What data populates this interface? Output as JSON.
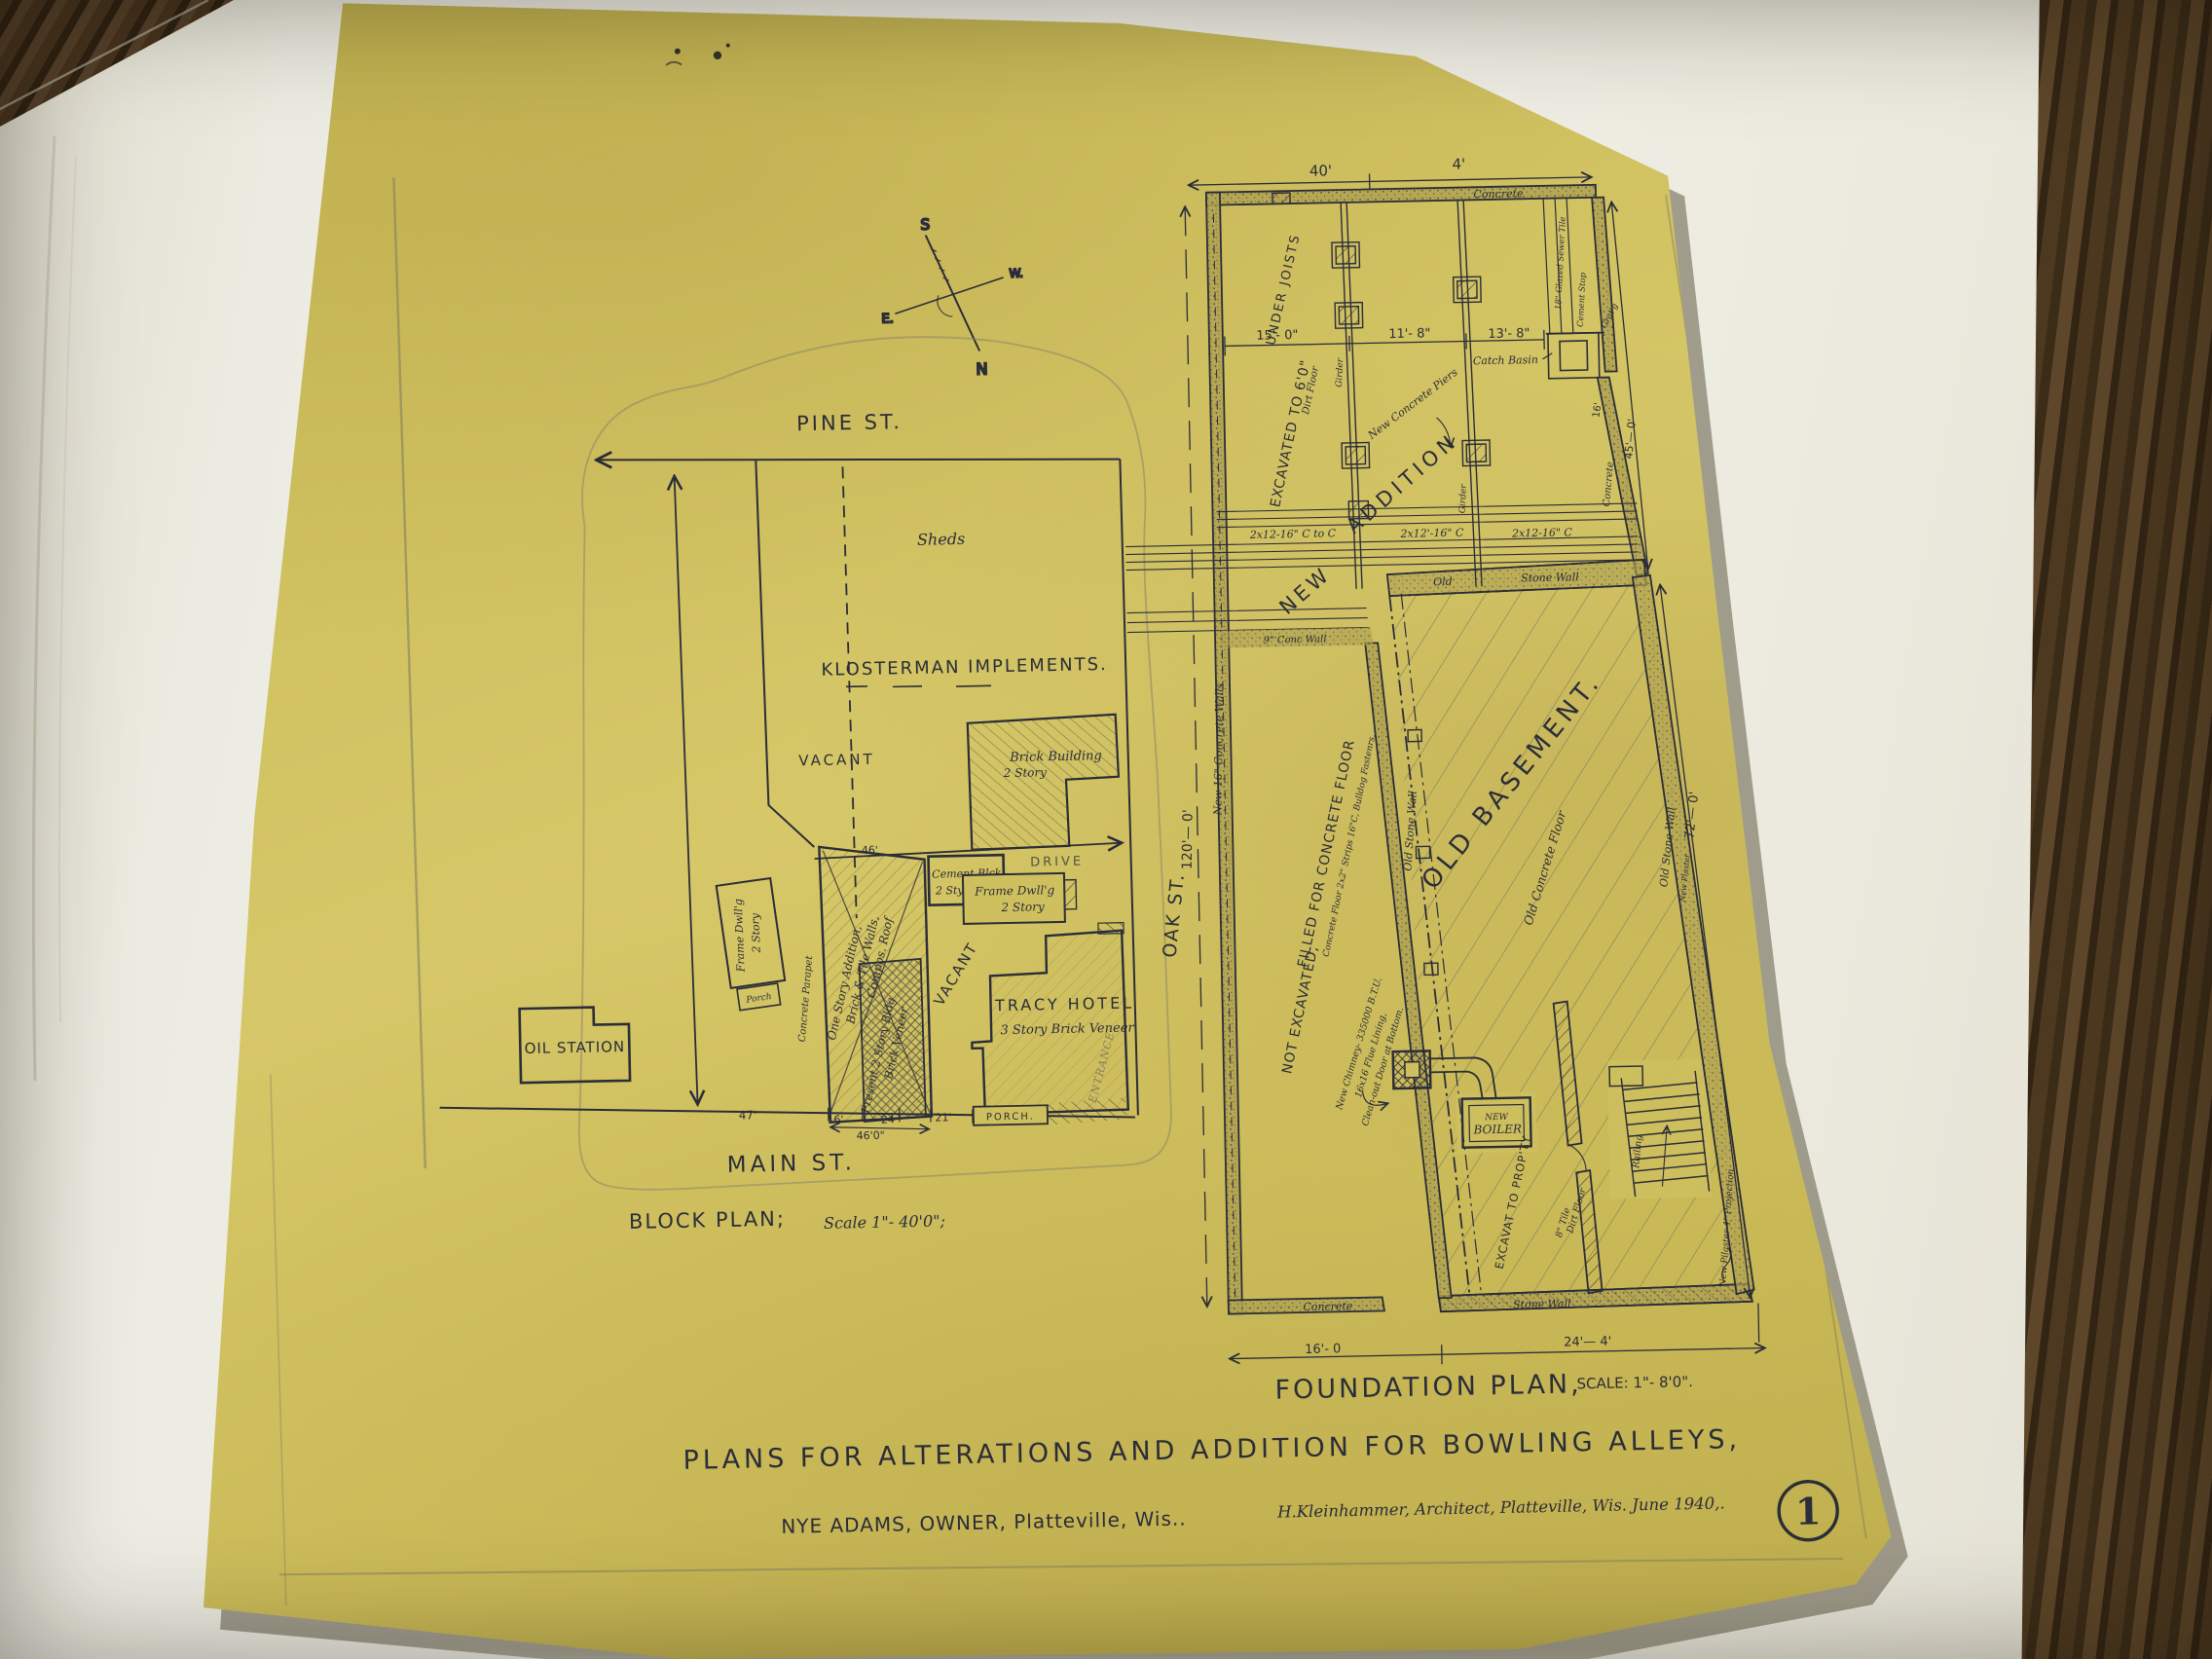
{
  "document": {
    "type": "architectural drawing photograph",
    "sheet_number": "1",
    "title": "PLANS FOR ALTERATIONS AND ADDITION FOR BOWLING ALLEYS,",
    "owner_line": "NYE ADAMS, OWNER, Platteville, Wis..",
    "architect_line": "H.Kleinhammer, Architect, Platteville, Wis. June 1940,.",
    "colors": {
      "paper": "#cfc05f",
      "ink": "#2b2d38",
      "pencil": "#84805e",
      "mat": "#ecebe1",
      "wood": "#4d3920"
    }
  },
  "compass": {
    "n": "N",
    "s": "S",
    "e": "E.",
    "w": "W."
  },
  "block_plan": {
    "caption": "BLOCK PLAN;",
    "scale": "Scale 1\"- 40'0\";",
    "streets": {
      "pine": "PINE ST.",
      "main": "MAIN ST.",
      "oak": "OAK ST."
    },
    "labels": {
      "sheds": "Sheds",
      "klosterman": "KLOSTERMAN IMPLEMENTS.",
      "vacant_parcel": "VACANT",
      "vacant_lot": "VACANT",
      "brick1": "Brick Building",
      "brick2": "2 Story",
      "drive": "DRIVE",
      "cement1": "Cement Blck",
      "cement2": "2 Sty",
      "frame_e1": "Frame Dwll'g",
      "frame_e2": "2 Story",
      "frame_w1": "Frame Dwll'g",
      "frame_w2": "2 Story",
      "porch_w": "Porch",
      "oil_station": "OIL STATION",
      "parapet": "Concrete Parapet",
      "osa1": "One Story Addition,",
      "osa2": "Brick & Tile Walls,",
      "osa3": "Compos. Roof",
      "pres1": "Present 2 Story Bldg",
      "pres2": "Brick Veneer",
      "tracy1": "TRACY HOTEL",
      "tracy2": "3 Story Brick Veneer",
      "entrance": "ENTRANCE",
      "porch_s": "PORCH."
    },
    "dims": {
      "d47": "47'",
      "d16": "16'",
      "d24": "24",
      "d21": "21'",
      "d460": "46'0\"",
      "d46": "46'"
    }
  },
  "foundation_plan": {
    "caption": "FOUNDATION PLAN,",
    "scale": "SCALE: 1\"- 8'0\".",
    "labels": {
      "concrete_top": "Concrete",
      "under_joists": "UNDER JOISTS",
      "excavated": "EXCAVATED TO 6'0\"",
      "dirt_floor": "Dirt Floor",
      "girder": "Girder",
      "piers": "New Concrete Piers",
      "addition": "ADDITION",
      "new": "NEW",
      "j1": "2x12-16\" C to C",
      "j2": "2x12'-16\" C",
      "j3": "2x12-16\" C",
      "old": "Old",
      "stone_wall": "Stone Wall",
      "conc9": "9\" Conc Wall",
      "new16": "New 16\" Concrete Walls",
      "catch_basin": "Catch Basin",
      "sewer": "18\" Glazed Sewer Tile",
      "cement_stop": "Cement Stop",
      "grating": "Grat'g",
      "concrete_r": "Concrete",
      "old_basement": "OLD BASEMENT.",
      "old_floor": "Old Concrete Floor",
      "osw_l": "Old Stone Wall",
      "osw_r": "Old Stone Wall",
      "new_plaster": "New Plaster",
      "not_exc": "NOT EXCAVATED,",
      "filled": "FILLED FOR CONCRETE FLOOR",
      "floor_note": "Concrete Floor 2x2\" Strips 16\"C, Bulldog Fastenrs.",
      "chim1": "New Chimney- 335000 B.T.U.",
      "chim2": "16x16 Flue Lining,",
      "chim3": "Clean-out Door at Bottom.",
      "boiler1": "NEW",
      "boiler2": "BOILER",
      "exc_prop": "EXCAVAT TO PROP'TY",
      "tile8": "8\" Tile",
      "dirt2": "Dirt Floor",
      "railing": "Railing",
      "pilaster": "New Pilaster 4\" Projection",
      "concrete_b": "Concrete",
      "stone_b": "Stone Wall"
    },
    "dims": {
      "t40": "40'",
      "t4": "4'",
      "d15": "15'- 0\"",
      "d11": "11'- 8\"",
      "d13": "13'- 8\"",
      "v120": "120'— 0'",
      "v72": "72'— 0'",
      "v45": "45'— 0'",
      "r16": "16'",
      "b16": "16'- 0",
      "b24": "24'— 4'"
    }
  }
}
